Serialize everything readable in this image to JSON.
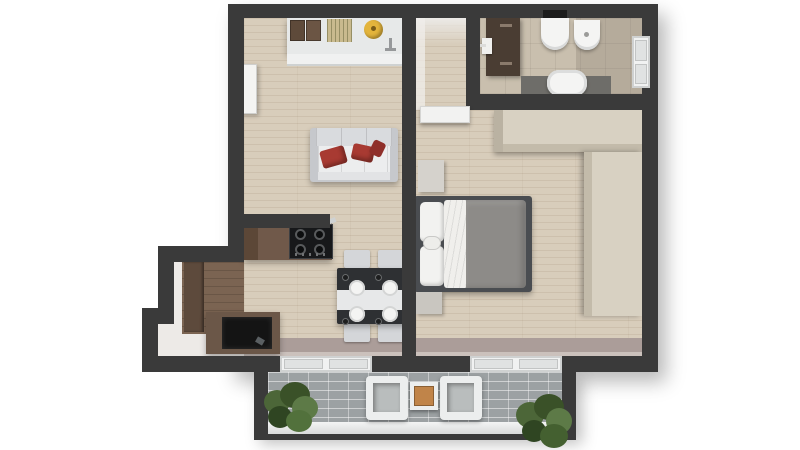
{
  "scene": {
    "type": "apartment-floor-plan-3d-top-view",
    "rooms": [
      {
        "name": "living-room-kitchen",
        "floor": "light wood planks"
      },
      {
        "name": "hallway",
        "floor": "light wood planks"
      },
      {
        "name": "bathroom",
        "floor": "beige tile"
      },
      {
        "name": "bedroom",
        "floor": "light wood planks"
      },
      {
        "name": "balcony",
        "floor": "gray brick pavers"
      }
    ],
    "furniture": {
      "kitchen_counter": "white kitchen counter with cutting boards, striped mat, yellow stand mixer and faucet",
      "cooktop": "black four-burner gas cooktop on wooden counter",
      "sofa": "light gray three-seat sofa with red cushions",
      "dining_table": "dark dining table with white runner, four plates, four glasses and four gray chairs",
      "tv_cabinet": "dark wood cabinet with black screen in stepped niche",
      "living_door": "white interior door on left wall",
      "hall_door": "white door from hallway to bedroom",
      "bath_door": "dark brown bathroom door with white handle",
      "toilet": "wall-hung toilet with black flush plate",
      "bidet": "bidet",
      "bathtub": "white bathtub on dark platform",
      "bath_window": "window in bathroom right wall",
      "bed": "double bed with dark frame, white pillows, white sheet and gray duvet",
      "nightstand": "beige nightstand",
      "ottoman": "gray ottoman at bed corner",
      "wardrobe": "L-shaped beige wardrobe along bedroom walls",
      "window_living": "window between living room and balcony",
      "window_bedroom": "window between bedroom and balcony",
      "balcony_chair": "white cube lounge chair",
      "balcony_table": "orange-top side table",
      "plant": "green potted shrub",
      "railing": "white balcony ledge"
    },
    "palette": {
      "wall": "#3a3a3a",
      "wood_floor": "#d8cdbb",
      "niche_wood": "#7b6452",
      "tile_floor": "#c9bfae",
      "window_strip": "#ab9d99",
      "brick_paver": "#9ca1a3",
      "cushion_red": "#a83a32",
      "duvet_gray": "#8d8b88",
      "wardrobe_beige": "#d8d1c2",
      "cabinet_brown": "#6b5748",
      "door_brown": "#4a3d33",
      "table_dark": "#2e3033",
      "balcony_table_orange": "#c08449",
      "plant_green": "#4c6638",
      "mixer_yellow": "#e3b43c",
      "fixture_white": "#f1f2f2"
    }
  }
}
